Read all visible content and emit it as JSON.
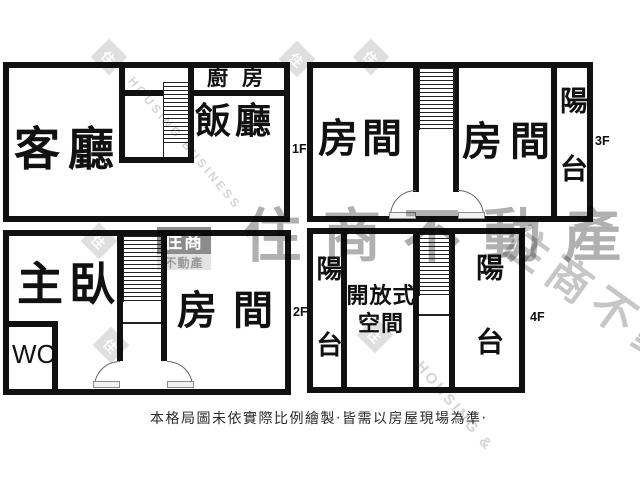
{
  "floors": {
    "f1": {
      "label": "1F",
      "living_room": "客廳",
      "dining_room": "飯廳",
      "kitchen": "廚房"
    },
    "f2": {
      "label": "2F",
      "master_bedroom": "主臥",
      "toilet": "WC",
      "room": "房間"
    },
    "f3": {
      "label": "3F",
      "room_left": "房間",
      "room_right": "房間",
      "balcony": "陽台"
    },
    "f4": {
      "label": "4F",
      "balcony_left": "陽台",
      "open_space": "開放式空間",
      "balcony_right": "陽台"
    }
  },
  "disclaimer": "本格局圖未依實際比例繪製‧皆需以房屋現場為準‧",
  "watermark": {
    "brand": "住商不動產",
    "logo_top": "住商",
    "logo_bottom": "不動產",
    "diagonal_brand": "住商不動產",
    "en_text_1": "HOUSING BUSINESS",
    "en_text_2": "HOUSING &",
    "diamond_char": "住"
  },
  "colors": {
    "wall": "#111111",
    "background": "#ffffff",
    "watermark_gray": "#b0b0b0"
  }
}
